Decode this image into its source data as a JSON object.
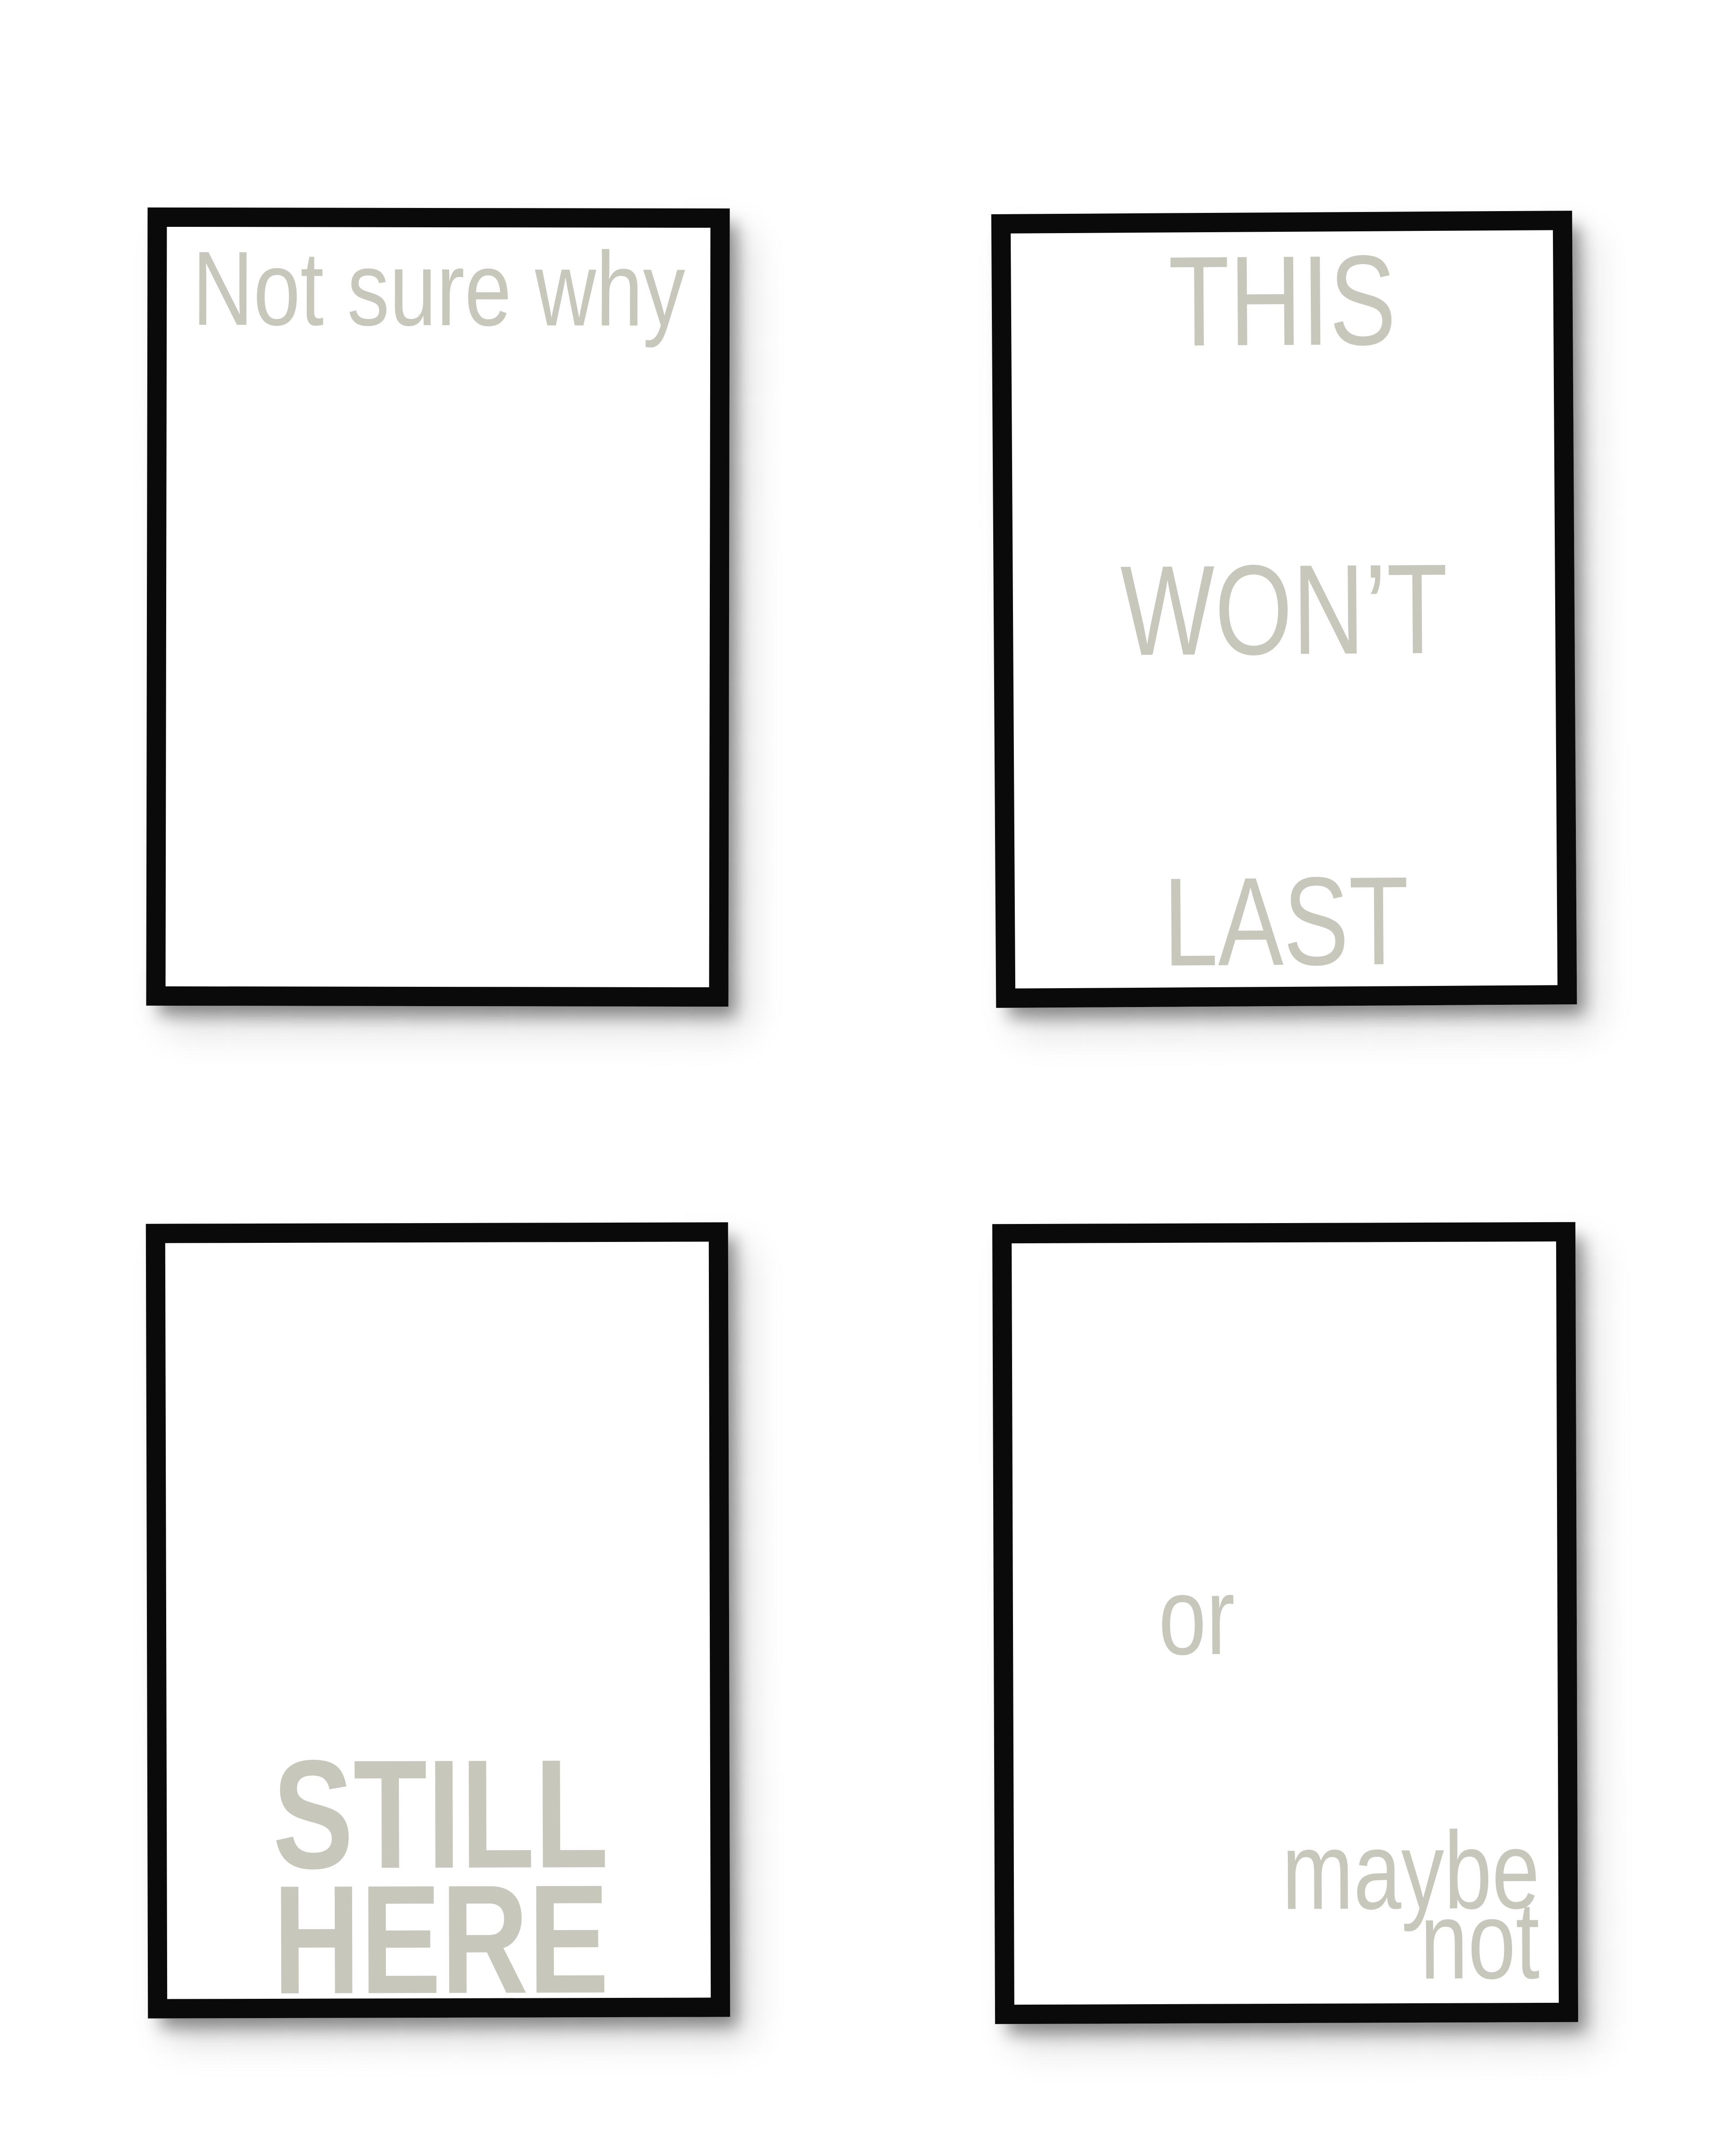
{
  "scene": {
    "description": "Four black-framed typographic posters hanging on a white wall",
    "background_color": "#ffffff"
  },
  "colors": {
    "wall": "#ffffff",
    "frame_border": "#0a0a0a",
    "poster_background": "#ffffff",
    "text": "#c8c7bc"
  },
  "posters": {
    "top_left": {
      "position": "top-left",
      "line1": "Not sure why"
    },
    "top_right": {
      "position": "top-right",
      "line1": "THIS",
      "line2": "WON’T",
      "line3": "LAST"
    },
    "bottom_left": {
      "position": "bottom-left",
      "line1": "STILL",
      "line2": "HERE"
    },
    "bottom_right": {
      "position": "bottom-right",
      "line1": "or",
      "line2": "maybe",
      "line3": "not"
    }
  }
}
